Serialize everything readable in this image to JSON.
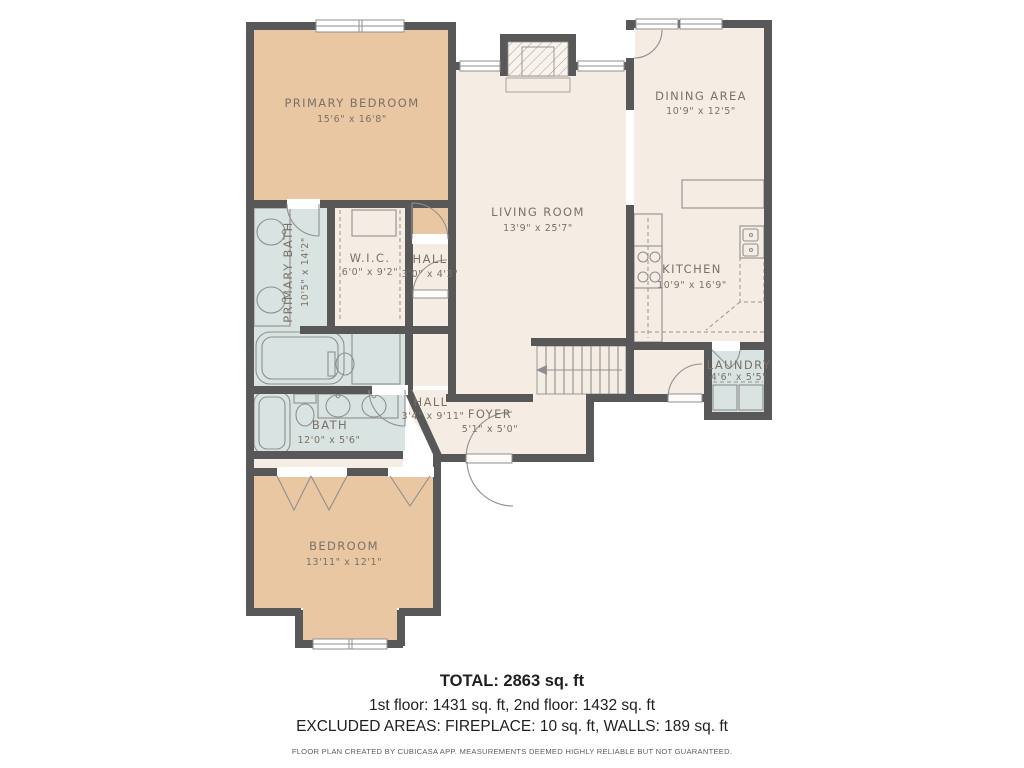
{
  "meta": {
    "colors": {
      "wall": "#585858",
      "bedroom_fill": "#e9c7a3",
      "common_fill": "#f5ede4",
      "wet_fill": "#d9e4e2",
      "label_text": "#7b7165",
      "fixture_stroke": "#8f8f8f",
      "footer_text": "#1f1f1f"
    }
  },
  "rooms": {
    "primary_bedroom": {
      "name": "PRIMARY BEDROOM",
      "dims": "15'6\" x 16'8\""
    },
    "dining_area": {
      "name": "DINING AREA",
      "dims": "10'9\" x 12'5\""
    },
    "living_room": {
      "name": "LIVING ROOM",
      "dims": "13'9\" x 25'7\""
    },
    "primary_bath": {
      "name": "PRIMARY BATH",
      "dims": "10'5\" x 14'2\""
    },
    "wic": {
      "name": "W.I.C.",
      "dims": "6'0\" x 9'2\""
    },
    "hall_upper": {
      "name": "HALL",
      "dims": "3'0\" x 4'3\""
    },
    "kitchen": {
      "name": "KITCHEN",
      "dims": "10'9\" x 16'9\""
    },
    "laundry": {
      "name": "LAUNDRY",
      "dims": "4'6\" x 5'5\""
    },
    "hall_lower": {
      "name": "HALL",
      "dims": "3'4\" x 9'11\""
    },
    "foyer": {
      "name": "FOYER",
      "dims": "5'1\" x 5'0\""
    },
    "bath": {
      "name": "BATH",
      "dims": "12'0\" x 5'6\""
    },
    "bedroom": {
      "name": "BEDROOM",
      "dims": "13'11\" x 12'1\""
    }
  },
  "footer": {
    "total": "TOTAL: 2863 sq. ft",
    "floors": "1st floor: 1431 sq. ft, 2nd floor: 1432 sq. ft",
    "excluded": "EXCLUDED AREAS: FIREPLACE: 10 sq. ft, WALLS: 189 sq. ft",
    "disclaimer": "FLOOR PLAN CREATED BY CUBICASA APP. MEASUREMENTS DEEMED HIGHLY RELIABLE BUT NOT GUARANTEED."
  }
}
